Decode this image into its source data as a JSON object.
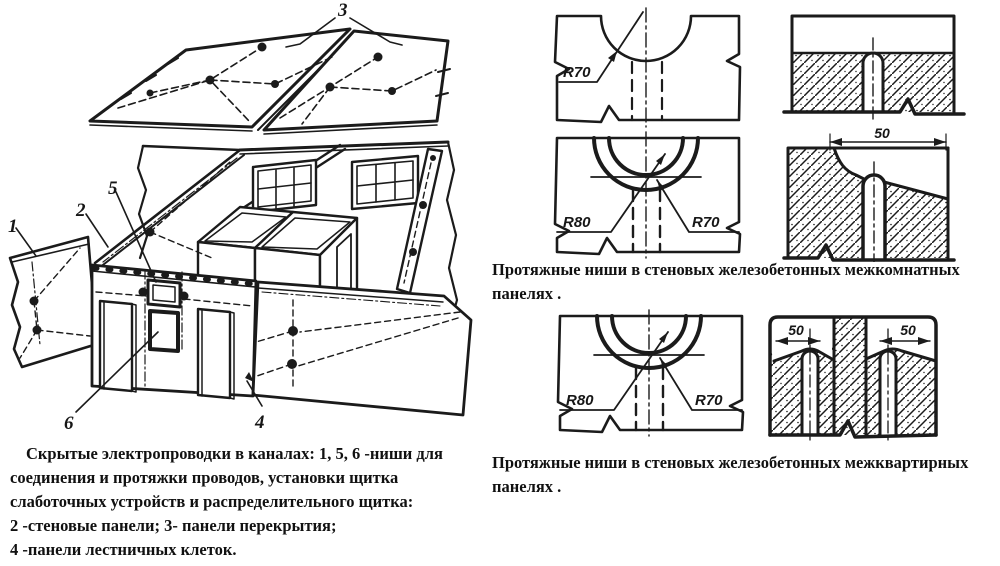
{
  "main_figure": {
    "numbers": {
      "n1": "1",
      "n2": "2",
      "n3": "3",
      "n4": "4",
      "n5": "5",
      "n6": "6"
    },
    "caption_lines": [
      "Скрытые электропроводки в каналах: 1, 5, 6 -ниши для",
      "соединения и протяжки проводов, установки щитка",
      "слаботочных устройств и распределительного щитка:",
      "2 -стеновые панели; 3- панели перекрытия;",
      "4 -панели лестничных клеток."
    ]
  },
  "right_column": {
    "caption_interroom": {
      "line1": "Протяжные ниши в стеновых железобетонных межкомнатных",
      "line2": "панелях ."
    },
    "caption_interapartment": {
      "line1": "Протяжные ниши в стеновых железобетонных межквартирных",
      "line2": "панелях ."
    },
    "diagram_r70": {
      "radius_label": "R70"
    },
    "diagram_r80_r70_top": {
      "radius_outer": "R80",
      "radius_inner": "R70"
    },
    "diagram_r80_r70_bottom": {
      "radius_outer": "R80",
      "radius_inner": "R70"
    },
    "diagram_channel_50": {
      "width_label": "50"
    },
    "diagram_double_channel": {
      "width_label_left": "50",
      "width_label_right": "50"
    }
  },
  "colors": {
    "ink": "#1b1b1b",
    "paper": "#ffffff"
  }
}
